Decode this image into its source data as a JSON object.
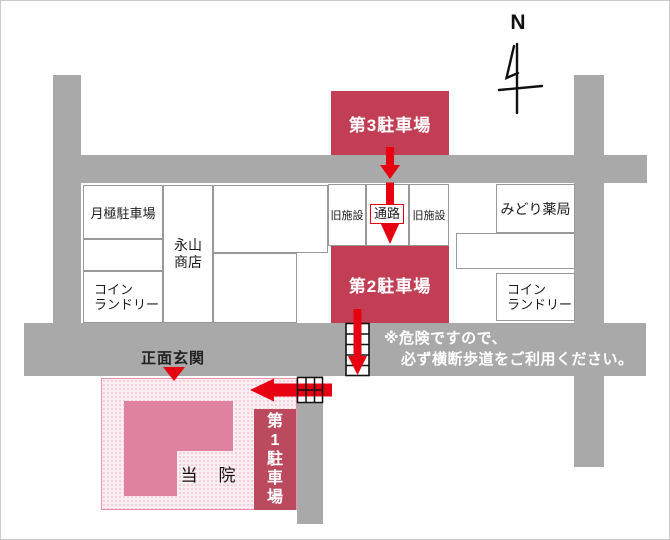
{
  "compass": {
    "label": "N"
  },
  "parking_lots": {
    "p3": {
      "label": "第3駐車場"
    },
    "p2": {
      "label": "第2駐車場"
    },
    "p1": {
      "label": "第1駐車場"
    }
  },
  "buildings": {
    "monthly_parking": {
      "label": "月極駐車場"
    },
    "nagayama_shoten": {
      "line1": "永山",
      "line2": "商店"
    },
    "coin_laundry_west": {
      "line1": "コイン",
      "line2": "ランドリー"
    },
    "old_facility_west": {
      "label": "旧施設"
    },
    "passage": {
      "label": "通路"
    },
    "old_facility_east": {
      "label": "旧施設"
    },
    "midori_pharmacy": {
      "label": "みどり薬局"
    },
    "coin_laundry_east": {
      "line1": "コイン",
      "line2": "ランドリー"
    },
    "clinic": {
      "label": "当　院"
    },
    "main_entrance": {
      "label": "正面玄関"
    }
  },
  "warning": {
    "line1": "※危険ですので、",
    "line2": "必ず横断歩道をご利用ください。"
  },
  "colors": {
    "road": "#a9a9a9",
    "parking_accent": "#c23e55",
    "parking1_accent": "#bc4a5f",
    "building_pink": "#de82a0",
    "clinic_area_bg": "#fdeef2",
    "arrow_red": "#e60012"
  }
}
